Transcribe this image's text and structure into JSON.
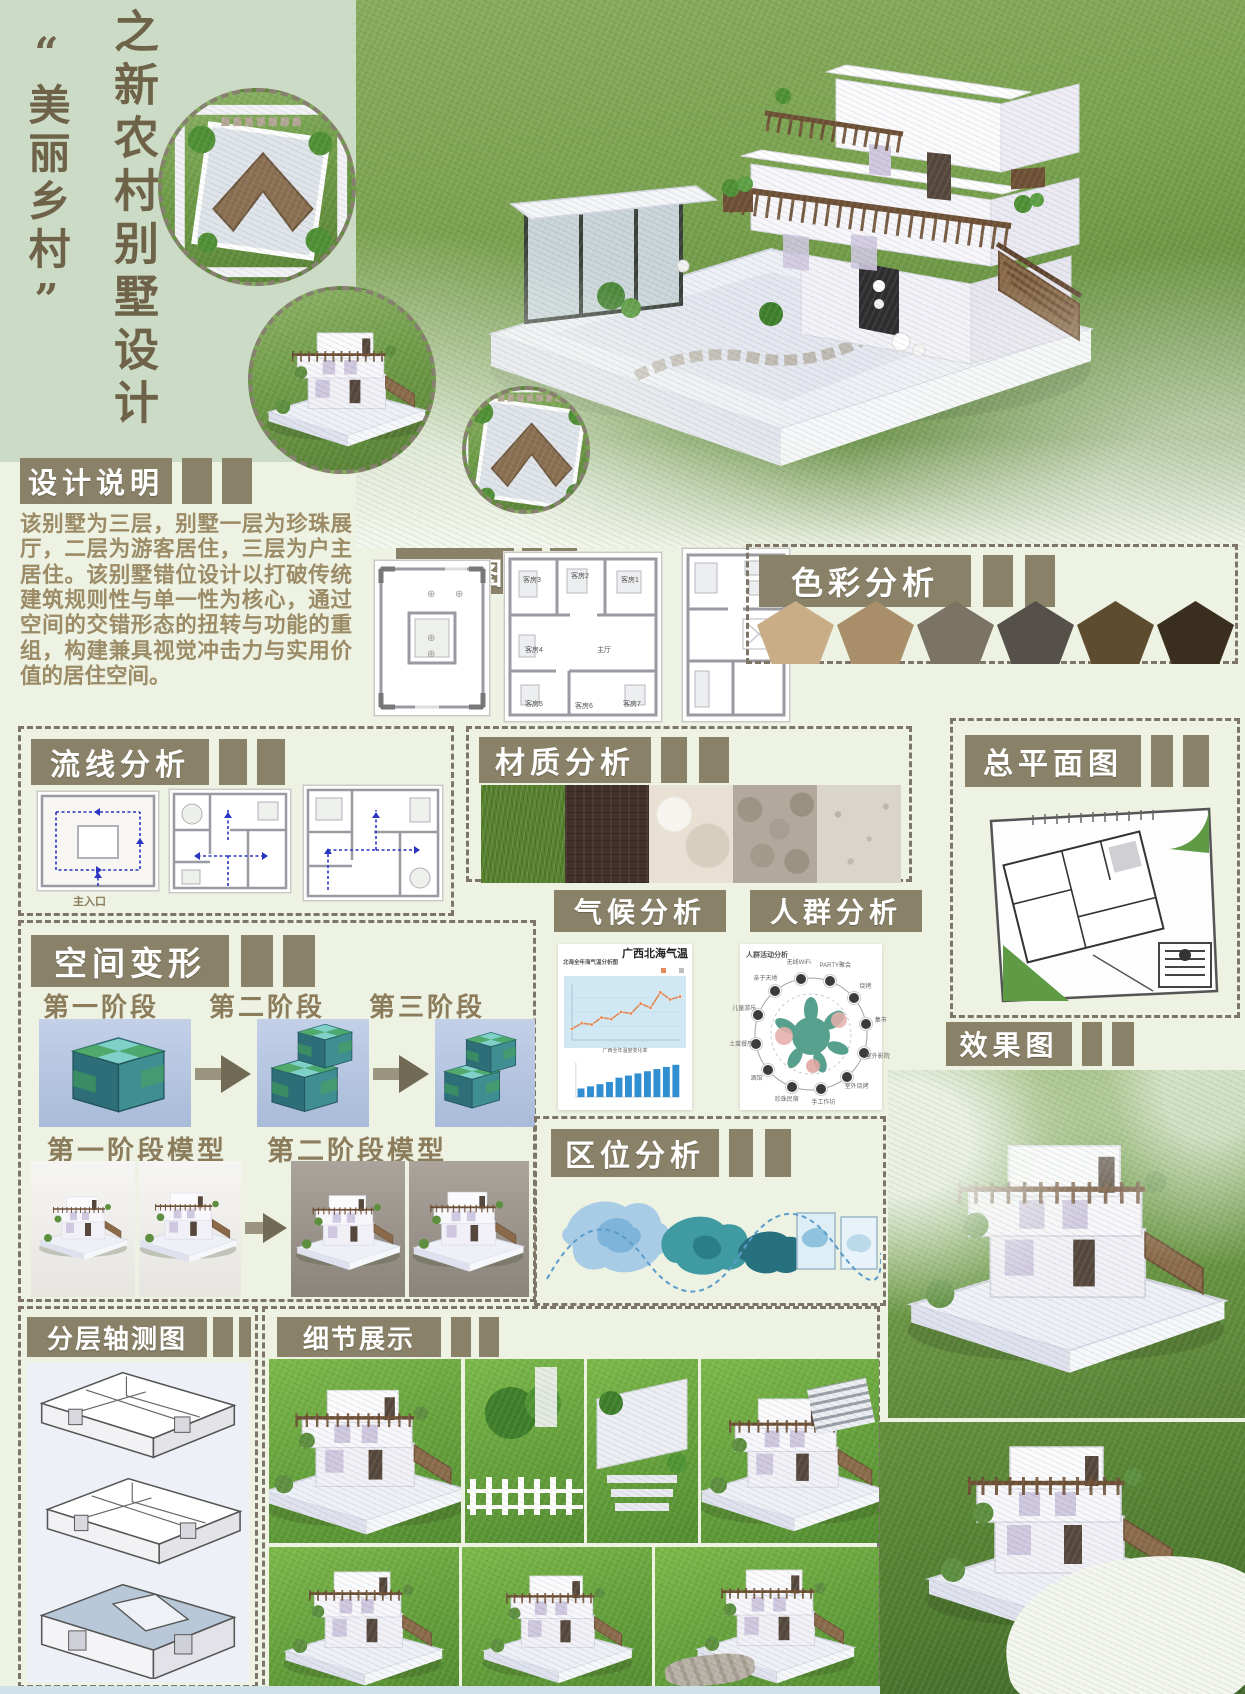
{
  "branding": {
    "series_title": "之新农村别墅设计",
    "theme_title": "“美丽乡村”"
  },
  "design_notes": {
    "title": "设计说明",
    "body": "该别墅为三层，别墅一层为珍珠展厅，二层为游客居住，三层为户主居住。该别墅错位设计以打破传统建筑规则性与单一性为核心，通过空间的交错形态的扭转与功能的重组，构建兼具视觉冲击力与实用价值的居住空间。"
  },
  "floor_plan": {
    "title": "平面图",
    "room_labels": [
      "客房3",
      "客房2",
      "客房1",
      "客房4",
      "主厅",
      "客房5",
      "客房6",
      "客房7"
    ]
  },
  "color_analysis": {
    "title": "色彩分析",
    "swatches": [
      "#c9ad87",
      "#a98e6a",
      "#7b7464",
      "#55504a",
      "#5e4c31",
      "#3a2e1e"
    ]
  },
  "circulation": {
    "title": "流线分析",
    "main_entrance_label": "主入口",
    "arrow_color": "#2a35c2"
  },
  "materials": {
    "title": "材质分析",
    "swatches": [
      "#55802c",
      "#43302a",
      "#e8e1d3",
      "#b2a89b",
      "#d9d5ca"
    ]
  },
  "master_plan": {
    "title": "总平面图"
  },
  "space_transform": {
    "title": "空间变形",
    "stage_labels": [
      "第一阶段",
      "第二阶段",
      "第三阶段"
    ],
    "model_labels": [
      "第一阶段模型",
      "第二阶段模型"
    ]
  },
  "climate": {
    "title": "气候分析",
    "chart_heading": "广西北海气温",
    "chart_subtitle": "北海全年海气温分析图",
    "bar_legend": "广西全年温度变化率"
  },
  "crowd": {
    "title": "人群分析",
    "diagram_title": "人群活动分析",
    "nodes": [
      "无线WiFi",
      "PARTY聚会",
      "烧烤",
      "集市",
      "室外影院",
      "室外烧烤",
      "手工作坊",
      "珍珠民宿",
      "酒馆",
      "土菜餐厅",
      "儿童游乐",
      "亲子天地"
    ]
  },
  "location": {
    "title": "区位分析"
  },
  "rendering": {
    "title": "效果图"
  },
  "axonometric": {
    "title": "分层轴测图"
  },
  "details": {
    "title": "细节展示"
  },
  "chart_data": [
    {
      "type": "line",
      "title": "广西北海气温",
      "subtitle": "北海全年海气温分析图",
      "x": [
        1,
        2,
        3,
        4,
        5,
        6,
        7,
        8,
        9,
        10,
        11,
        12
      ],
      "values": [
        14,
        16,
        15.5,
        18,
        17.5,
        20,
        19.5,
        23,
        21.5,
        27,
        24.5,
        25.5
      ],
      "xlabel": "月",
      "ylabel": "气温(℃)",
      "ylim": [
        10,
        30
      ],
      "line_color": "#e08a5a",
      "plot_bg": "#cfe8f4",
      "legend_position": "top-right"
    },
    {
      "type": "bar",
      "title": "广西全年温度变化率",
      "categories": [
        "1",
        "2",
        "3",
        "4",
        "5",
        "6",
        "7",
        "8",
        "9",
        "10",
        "11"
      ],
      "values": [
        2,
        2.5,
        3,
        3.5,
        4.5,
        5,
        5.5,
        6,
        6.5,
        7,
        7.5
      ],
      "ylim": [
        0,
        8
      ],
      "bar_color": "#2f8fd0"
    }
  ]
}
